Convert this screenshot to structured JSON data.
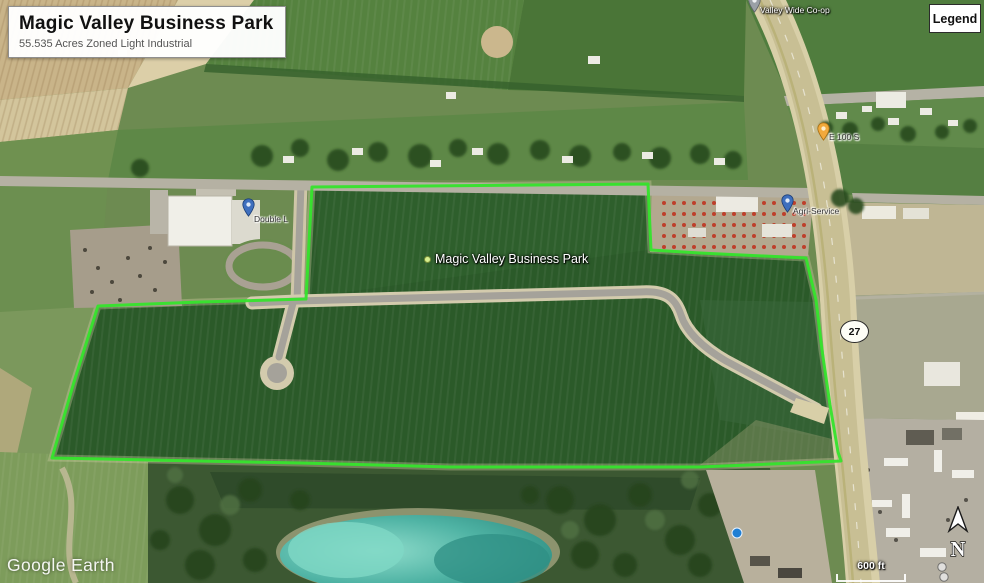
{
  "header": {
    "title": "Magic Valley Business Park",
    "subtitle": "55.535 Acres Zoned Light Industrial"
  },
  "legend": {
    "label": "Legend"
  },
  "map": {
    "site_label": "Magic Valley Business Park",
    "placemarks": {
      "double_l": "Double L",
      "agri_service": "Agri-Service",
      "valley_wide": "Valley Wide Co-op",
      "e_100_s": "E 100 S"
    },
    "route_shield": "27"
  },
  "scale": {
    "label": "600 ft"
  },
  "compass": {
    "north": "N"
  },
  "watermark": {
    "text": "Google Earth"
  },
  "colors": {
    "boundary_green": "#35e42c",
    "pond_teal": "#4fb3a4",
    "highway_tan": "#d8cfa8",
    "field_dark_green": "#2b5a29",
    "title_text": "#111111",
    "subtitle_text": "#555555"
  }
}
